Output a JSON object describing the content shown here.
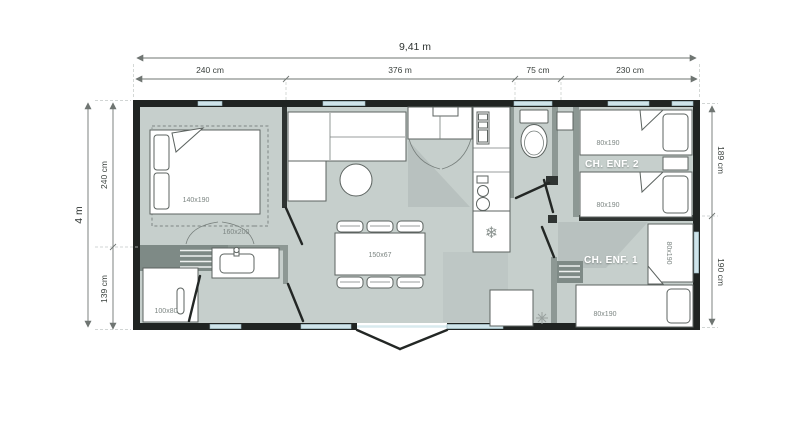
{
  "plan": {
    "dimensions": {
      "top_total": "9,41 m",
      "top_segments": [
        "240 cm",
        "376 m",
        "75 cm",
        "230 cm"
      ],
      "left_total": "4 m",
      "left_segments": [
        "240 cm",
        "139 cm"
      ],
      "right_segments": [
        "189 cm",
        "190 cm"
      ]
    },
    "rooms": {
      "master_bedroom": {
        "bed": "140x190",
        "bed_option": "160x200"
      },
      "bathroom": {
        "shower": "100x80"
      },
      "living": {
        "table": "150x67"
      },
      "kids2": {
        "name": "CH. ENF. 2",
        "bed_top": "80x190",
        "bed_bottom": "80x190"
      },
      "kids1": {
        "name": "CH. ENF. 1",
        "bed_right": "80x190",
        "bed_bottom": "80x190"
      }
    },
    "icons": {
      "snowflake": "❄"
    },
    "colors": {
      "floor": "#c6cfcc",
      "wall": "#202422",
      "interior_wall": "#8d9894",
      "window": "#cfe4ea",
      "room_label": "#ffffff",
      "dimension_text": "#2f3432"
    }
  }
}
